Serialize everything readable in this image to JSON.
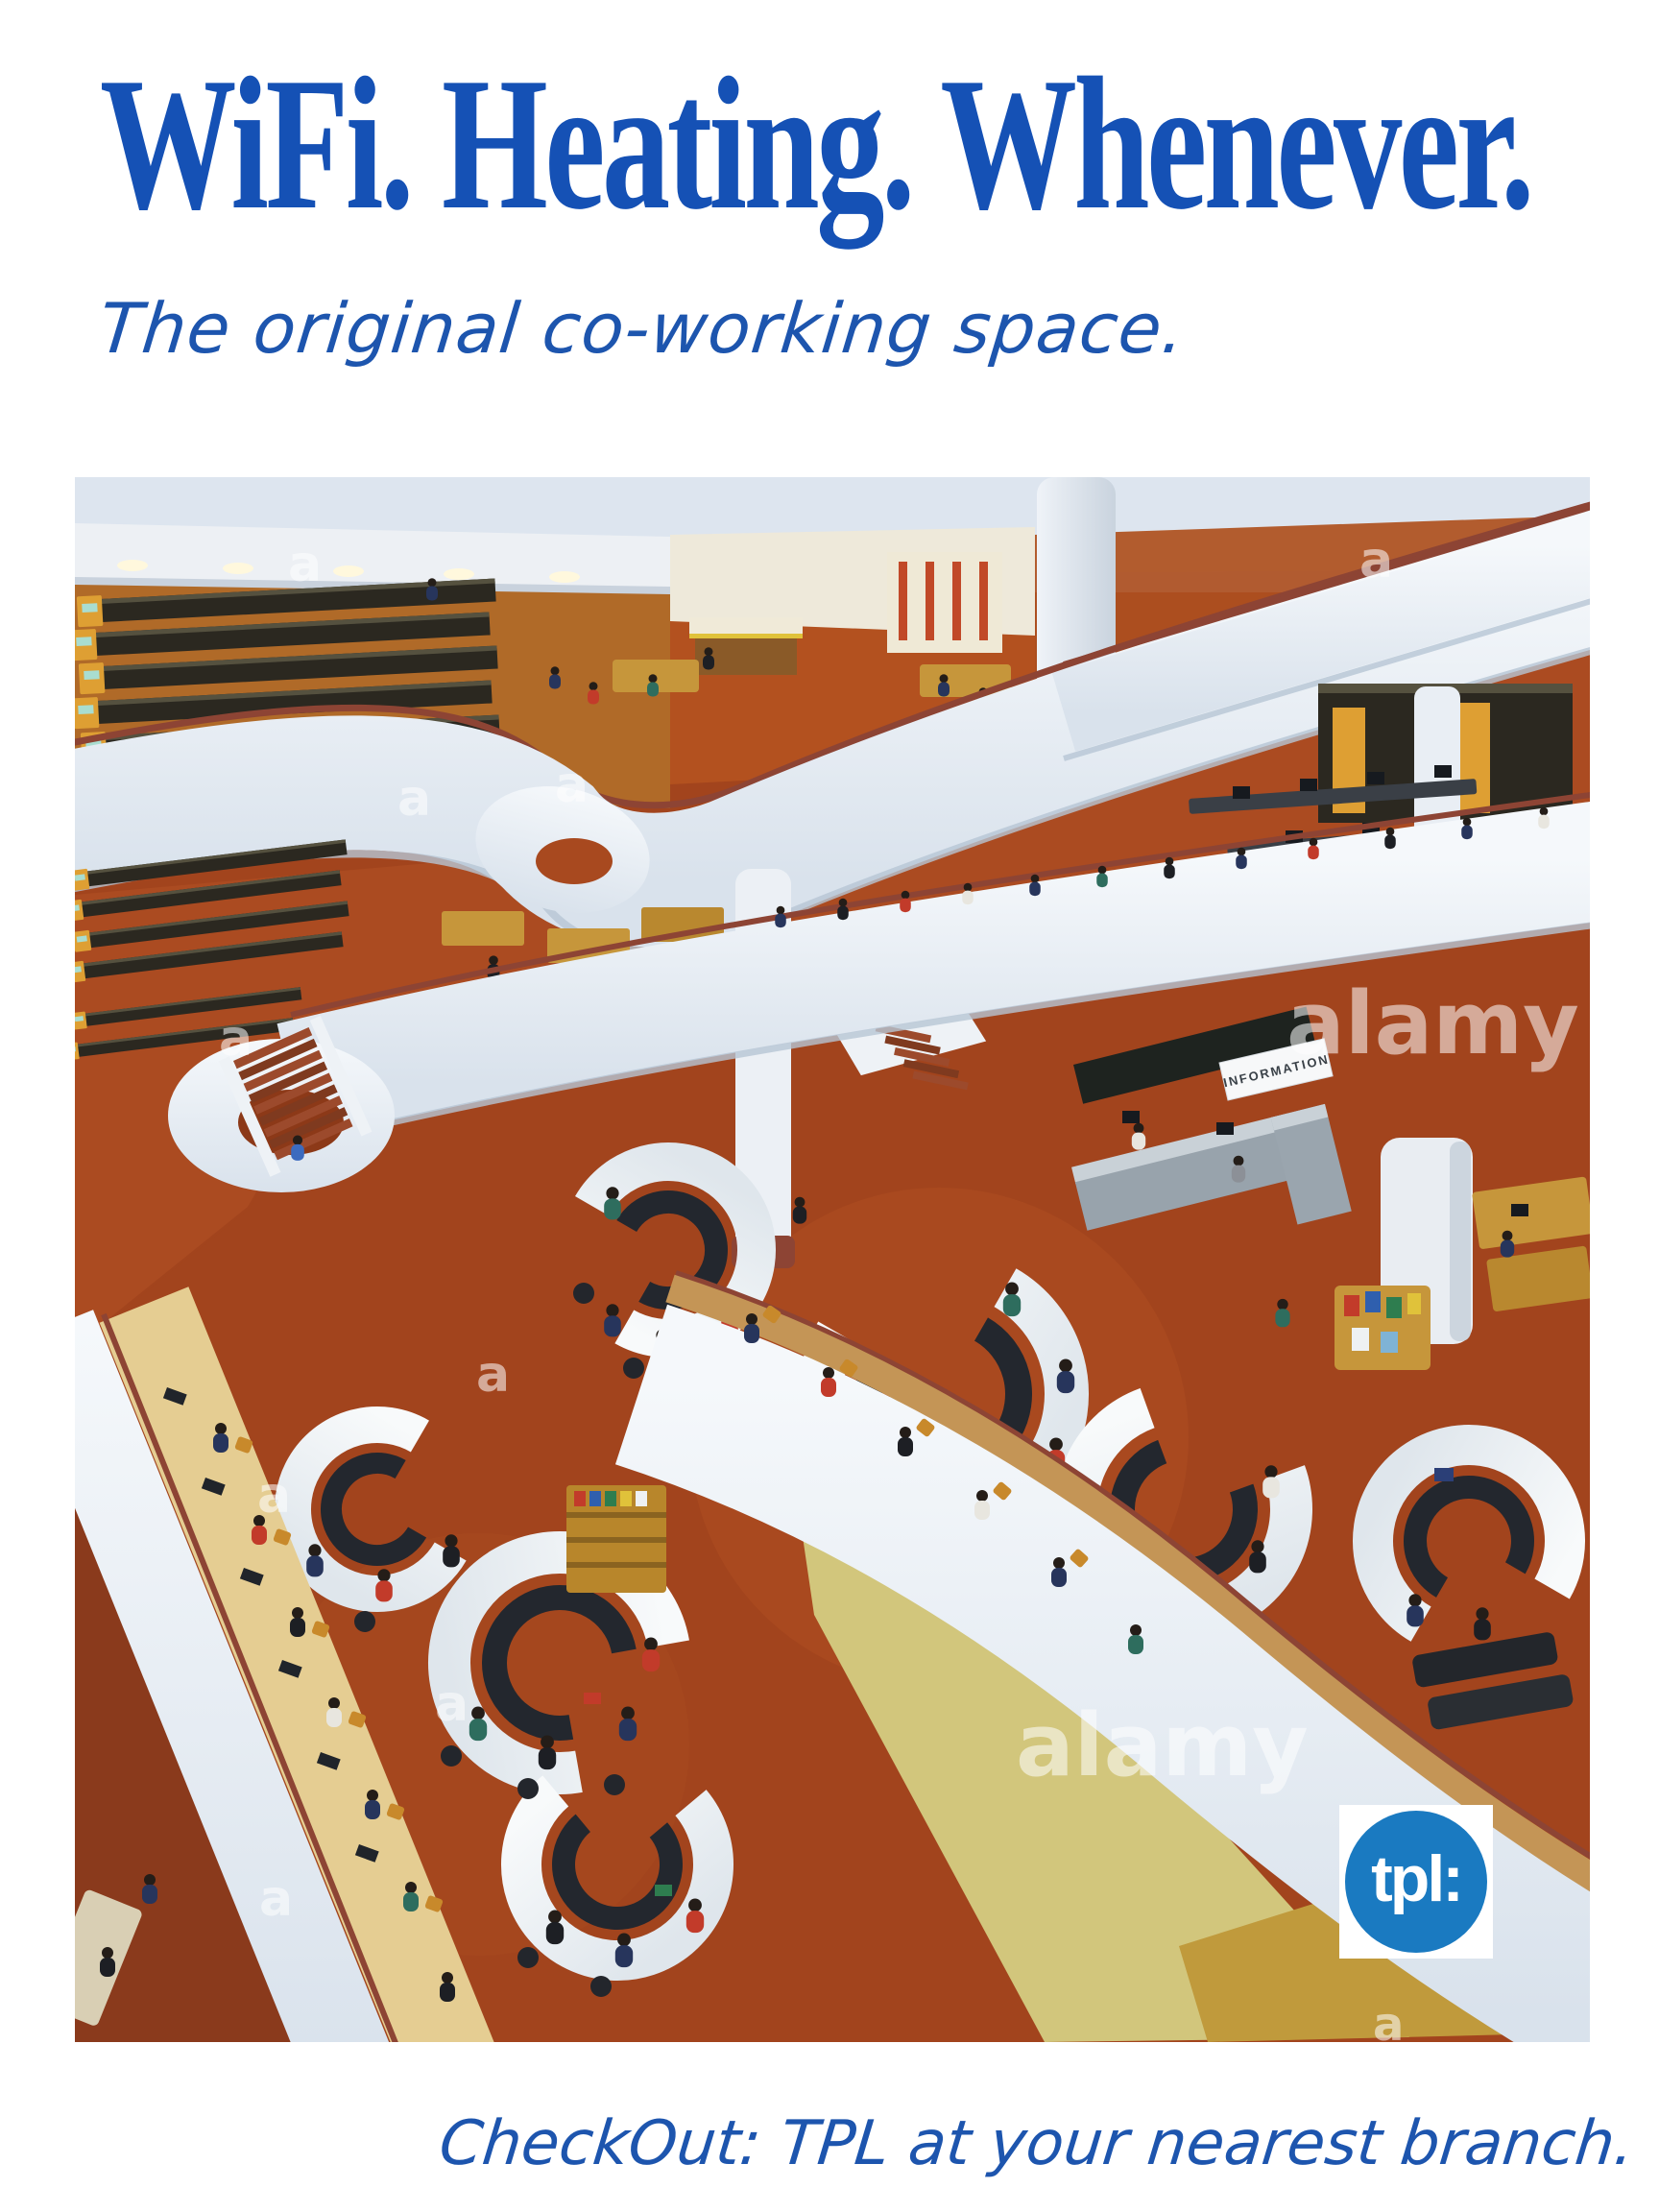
{
  "poster": {
    "headline": "WiFi. Heating. Whenever.",
    "subheadline": "The original co-working space.",
    "footer_tagline": "CheckOut: TPL at your nearest branch.",
    "colors": {
      "headline_blue": "#1551b5",
      "script_blue": "#1d55ae",
      "background": "#ffffff"
    }
  },
  "photo": {
    "watermark": "alamy",
    "watermark_letter": "a",
    "info_desk_sign": "INFORMATION",
    "palette": {
      "carpet": "#a2441d",
      "carpet_dark": "#8a3a1c",
      "balcony_white": "#eef2f7",
      "trim_brown": "#8d4434",
      "ledge_tan": "#c49556",
      "shelf_yellow": "#de9f33",
      "olive_floor": "#d2c67c",
      "gold_floor": "#c09a3c",
      "desk_white": "#f5f7f8",
      "bench_dark": "#23272e",
      "grey_desk": "#9aa5ae",
      "wood": "#c6963b",
      "ceiling": "#dde5ef"
    }
  },
  "logo": {
    "text": "tpl:",
    "color": "#1a7ac1"
  }
}
